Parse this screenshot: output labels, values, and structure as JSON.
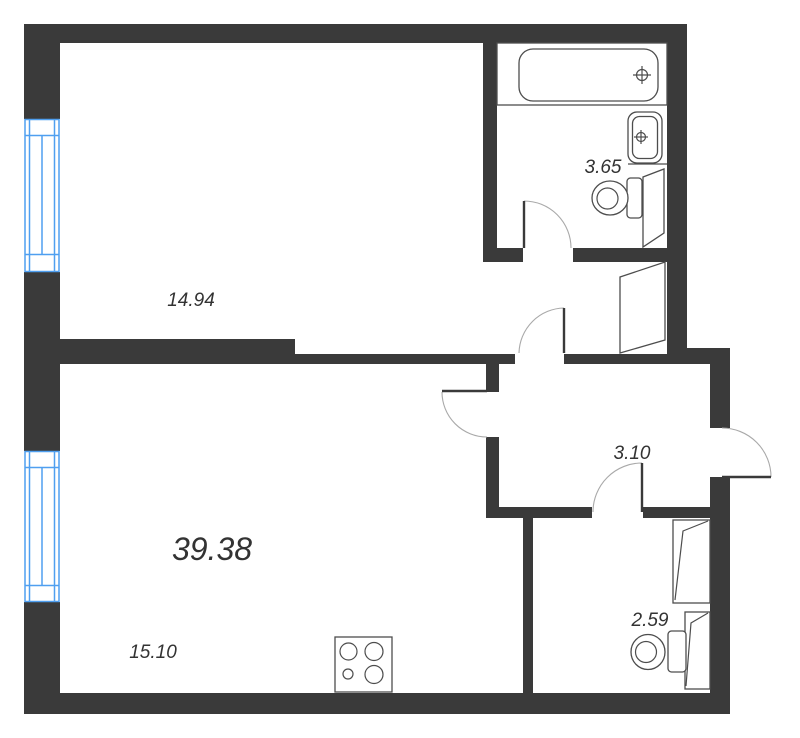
{
  "floorplan": {
    "total_area": {
      "label": "39.38"
    },
    "rooms": [
      {
        "id": "top-room",
        "area_label": "14.94"
      },
      {
        "id": "bathroom",
        "area_label": "3.65"
      },
      {
        "id": "hallway",
        "area_label": "3.10"
      },
      {
        "id": "kitchen-living-room",
        "area_label": "15.10"
      },
      {
        "id": "wc",
        "area_label": "2.59"
      }
    ],
    "fixtures": [
      "bathtub",
      "sink",
      "toilet-bathroom",
      "toilet-wc",
      "stove-4-burners",
      "window-top-left",
      "window-bottom-left",
      "door-top-room",
      "door-bathroom",
      "door-living-room",
      "door-wc",
      "entrance-door",
      "door-panel-bathroom",
      "door-panel-nook",
      "door-panel-wc-upper",
      "door-panel-wc-lower"
    ],
    "colors": {
      "wall": "#3a3a3a",
      "window_frame": "#4f9ff0",
      "fixture_outline": "#4d4d4d",
      "door_arc": "#a9a9a9",
      "label_text": "#333333",
      "background": "#ffffff"
    }
  }
}
